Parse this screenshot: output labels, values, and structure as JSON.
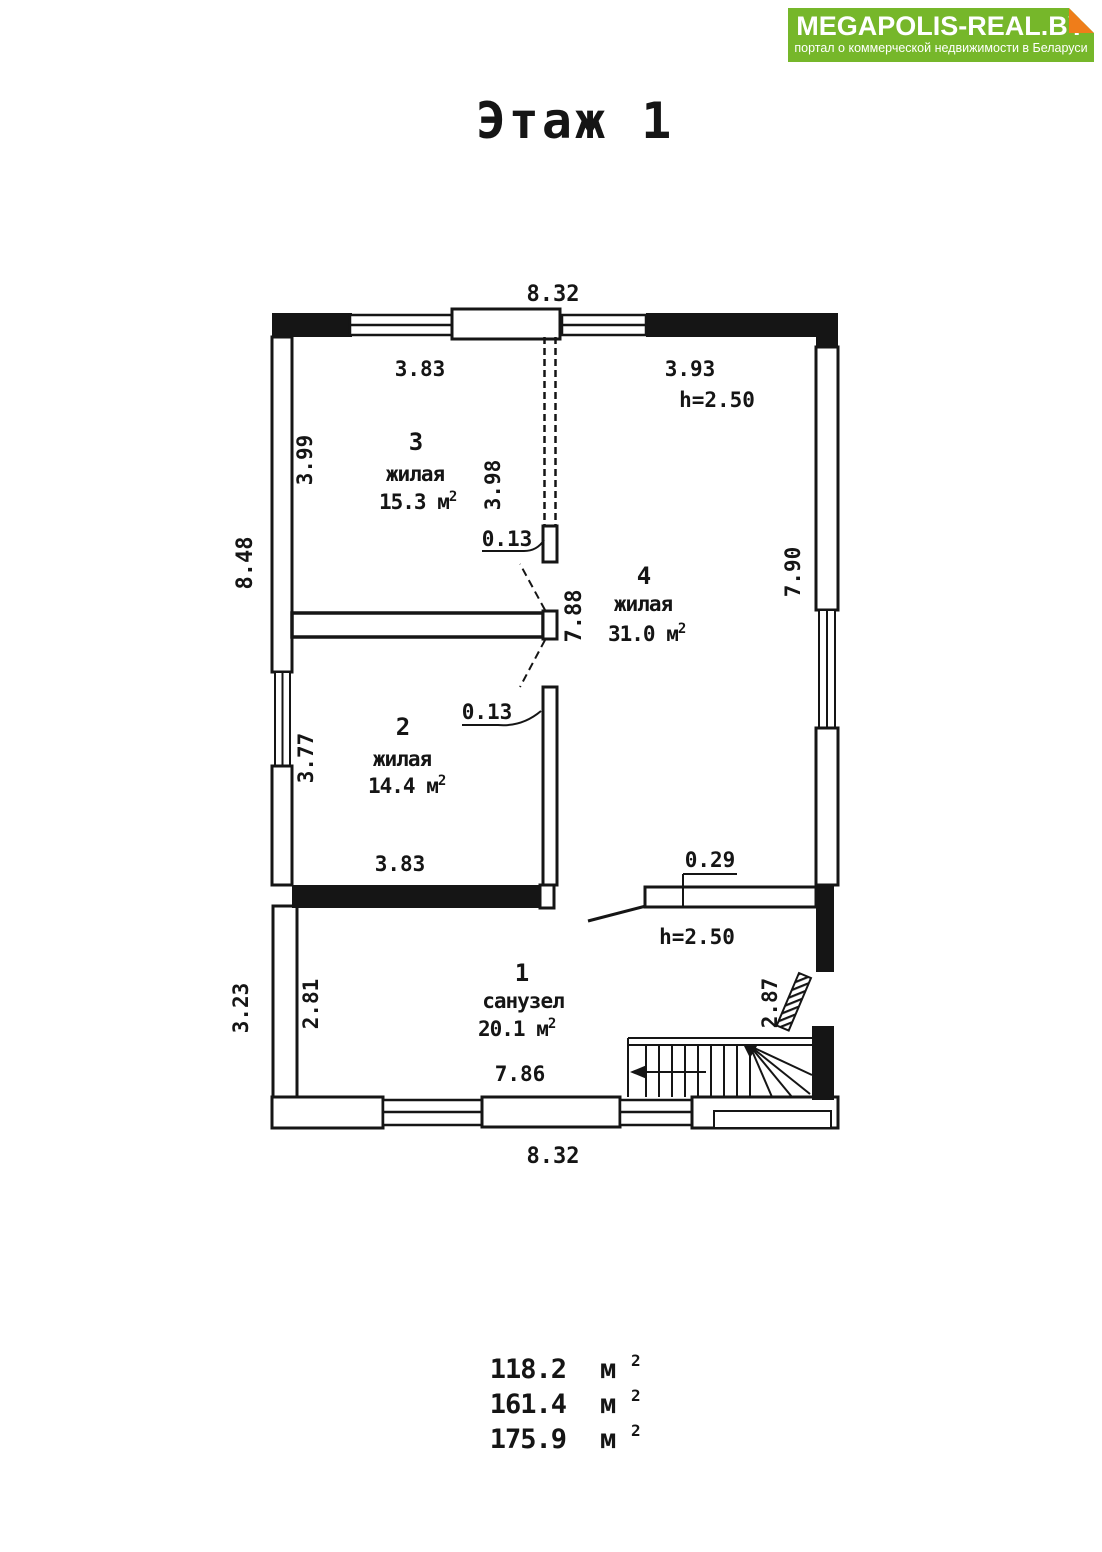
{
  "header": {
    "brand": "MEGAPOLIS-REAL.BY",
    "tagline": "портал о коммерческой недвижимости в Беларуси",
    "brand_green": "#76b72a",
    "fold_orange": "#ef7d1a",
    "ink": "#151515"
  },
  "title": "Этаж 1",
  "plan": {
    "rooms": {
      "r3": {
        "num": "3",
        "name": "жилая",
        "area": "15.3 м",
        "area_sup": "2"
      },
      "r4": {
        "num": "4",
        "name": "жилая",
        "area": "31.0 м",
        "area_sup": "2"
      },
      "r2": {
        "num": "2",
        "name": "жилая",
        "area": "14.4 м",
        "area_sup": "2"
      },
      "r1": {
        "num": "1",
        "name": "санузел",
        "area": "20.1 м",
        "area_sup": "2"
      }
    },
    "dims": {
      "top": "8.32",
      "bottom": "8.32",
      "r3_top": "3.83",
      "r4_top": "3.93",
      "r4_height": "h=2.50",
      "r1_height": "h=2.50",
      "r3_left": "3.99",
      "r3_partition": "3.98",
      "left_total": "8.48",
      "hall": "7.88",
      "r4_right": "7.90",
      "partition_t1": "0.13",
      "partition_t2": "0.13",
      "r2_left": "3.77",
      "r2_bottom": "3.83",
      "niche": "0.29",
      "r1_left": "2.81",
      "lower_left": "3.23",
      "r1_right": "2.87",
      "r1_width": "7.86"
    }
  },
  "totals": [
    {
      "value": "118.2",
      "unit": "м",
      "sup": "2"
    },
    {
      "value": "161.4",
      "unit": "м",
      "sup": "2"
    },
    {
      "value": "175.9",
      "unit": "м",
      "sup": "2"
    }
  ]
}
